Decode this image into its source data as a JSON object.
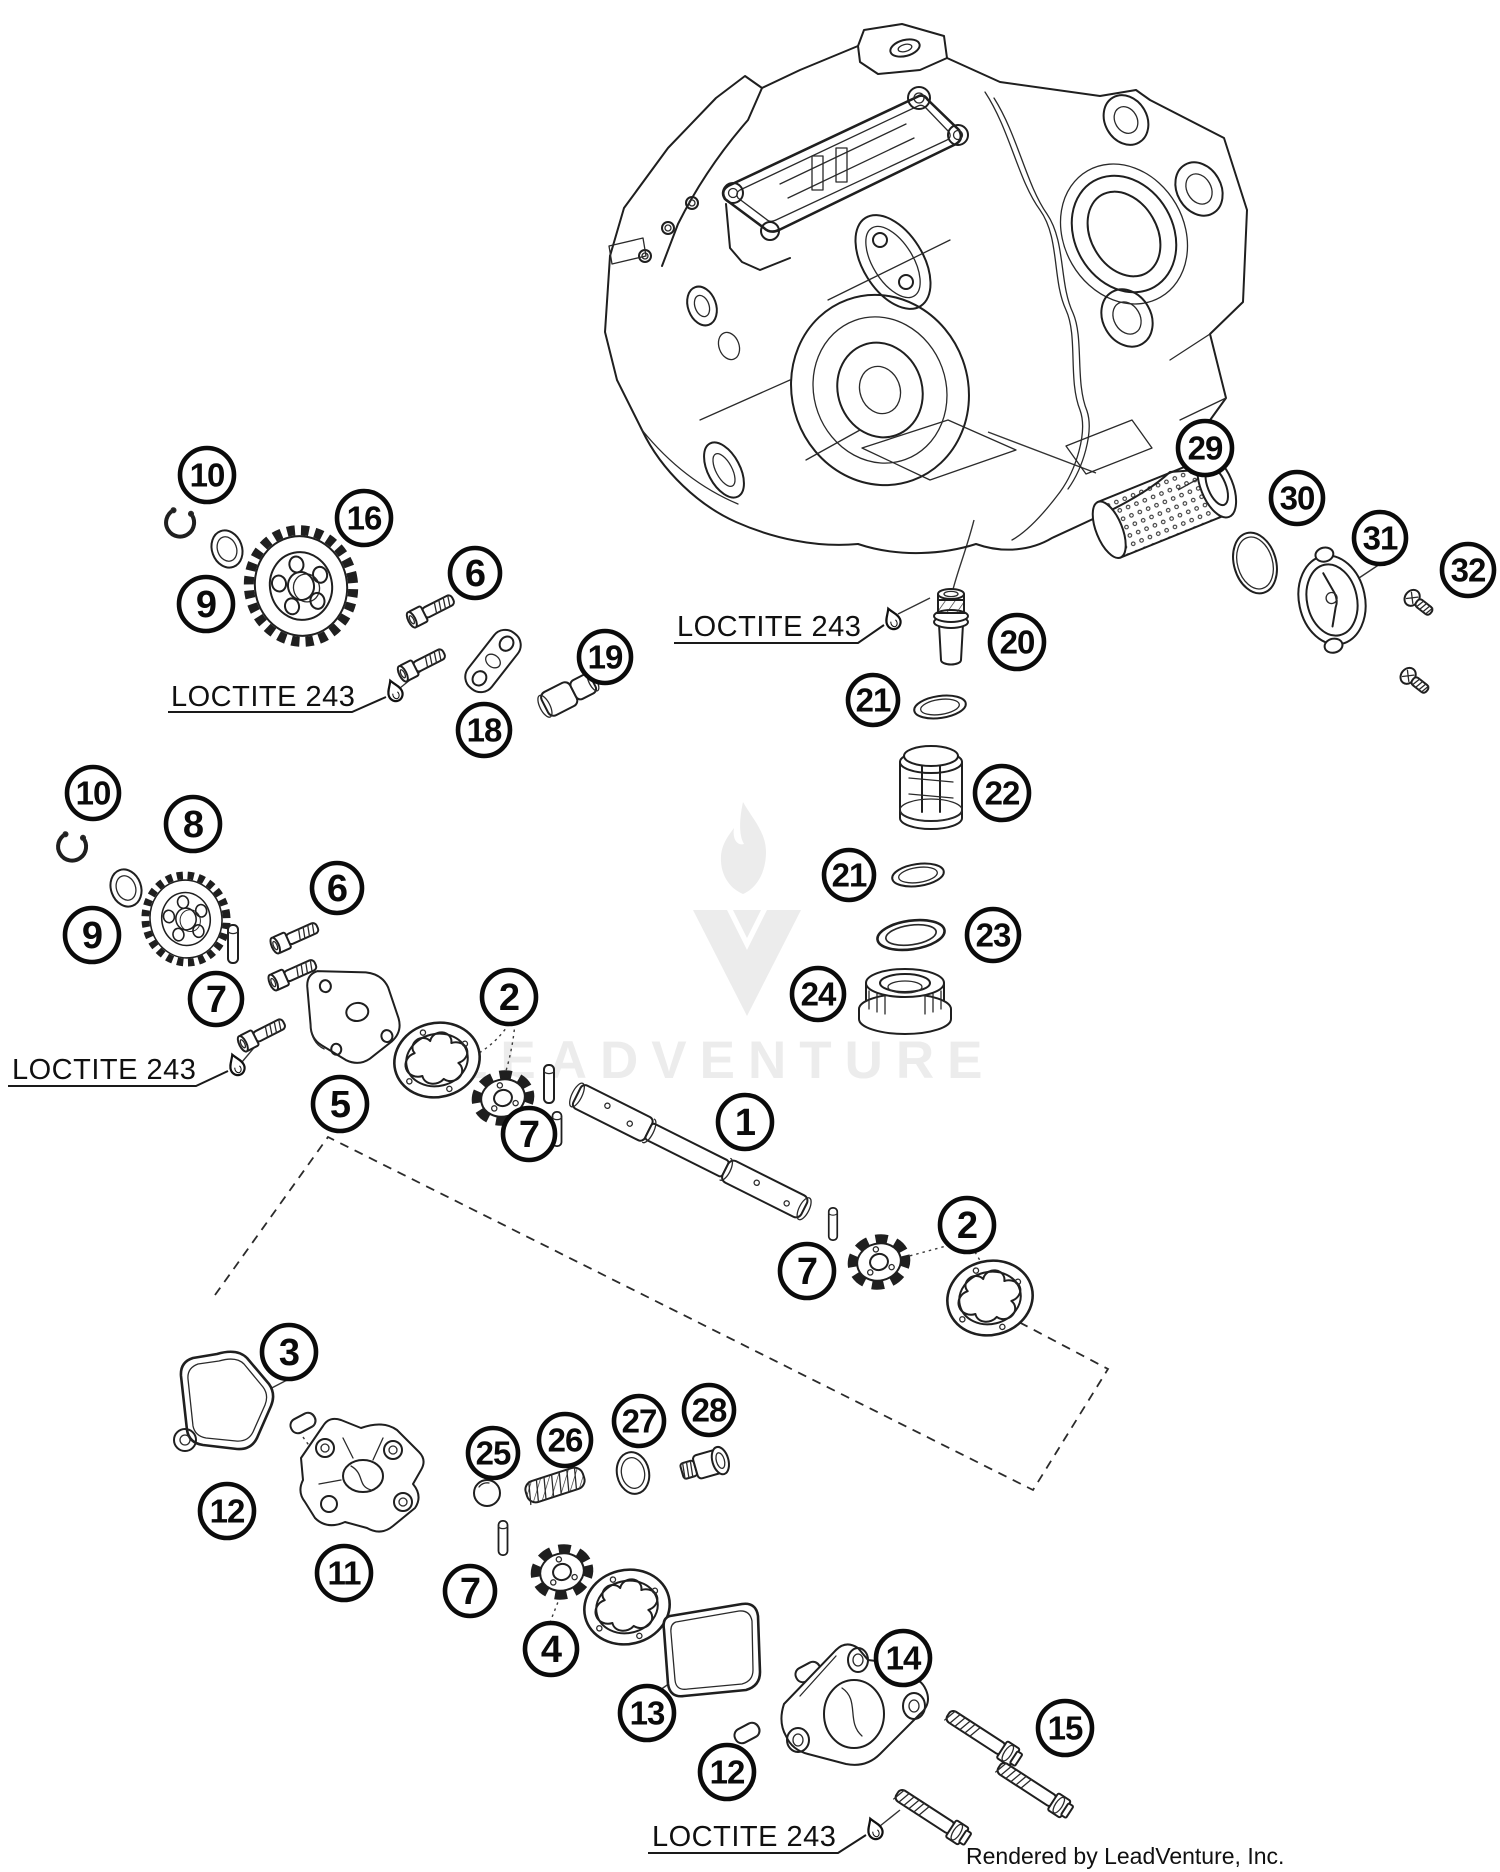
{
  "colors": {
    "line": "#1f1f1f",
    "callout": "#0b0b0b",
    "watermark": "#ececec",
    "background": "#ffffff"
  },
  "watermark": {
    "text": "LEADVENTURE"
  },
  "footer": {
    "credit": "Rendered by LeadVenture, Inc."
  },
  "annotations": {
    "loctite": [
      {
        "text": "LOCTITE 243",
        "tx": 171,
        "ty": 706,
        "ux1": 168,
        "ux2": 352,
        "uy": 712,
        "lx": 386,
        "ly": 697,
        "dx": 394,
        "dy": 690
      },
      {
        "text": "LOCTITE 243",
        "tx": 12,
        "ty": 1079,
        "ux1": 8,
        "ux2": 196,
        "uy": 1086,
        "lx": 228,
        "ly": 1071,
        "dx": 236,
        "dy": 1064
      },
      {
        "text": "LOCTITE 243",
        "tx": 677,
        "ty": 636,
        "ux1": 674,
        "ux2": 858,
        "uy": 643,
        "lx": 884,
        "ly": 625,
        "dx": 892,
        "dy": 618
      },
      {
        "text": "LOCTITE 243",
        "tx": 652,
        "ty": 1846,
        "ux1": 648,
        "ux2": 838,
        "uy": 1853,
        "lx": 866,
        "ly": 1835,
        "dx": 874,
        "dy": 1828
      }
    ]
  },
  "callouts": [
    {
      "label": "10",
      "x": 207,
      "y": 475,
      "r": 27
    },
    {
      "label": "16",
      "x": 364,
      "y": 518,
      "r": 27
    },
    {
      "label": "9",
      "x": 206,
      "y": 604,
      "r": 27
    },
    {
      "label": "6",
      "x": 475,
      "y": 573,
      "r": 25
    },
    {
      "label": "19",
      "x": 605,
      "y": 657,
      "r": 26
    },
    {
      "label": "18",
      "x": 484,
      "y": 730,
      "r": 26
    },
    {
      "label": "29",
      "x": 1205,
      "y": 448,
      "r": 27
    },
    {
      "label": "30",
      "x": 1297,
      "y": 498,
      "r": 26
    },
    {
      "label": "31",
      "x": 1380,
      "y": 538,
      "r": 26
    },
    {
      "label": "32",
      "x": 1468,
      "y": 570,
      "r": 26
    },
    {
      "label": "20",
      "x": 1017,
      "y": 642,
      "r": 27
    },
    {
      "label": "21",
      "x": 873,
      "y": 700,
      "r": 25
    },
    {
      "label": "22",
      "x": 1002,
      "y": 793,
      "r": 27
    },
    {
      "label": "21",
      "x": 849,
      "y": 875,
      "r": 25
    },
    {
      "label": "23",
      "x": 993,
      "y": 935,
      "r": 26
    },
    {
      "label": "24",
      "x": 818,
      "y": 994,
      "r": 26
    },
    {
      "label": "10",
      "x": 93,
      "y": 793,
      "r": 26
    },
    {
      "label": "8",
      "x": 193,
      "y": 824,
      "r": 27
    },
    {
      "label": "9",
      "x": 92,
      "y": 935,
      "r": 27
    },
    {
      "label": "6",
      "x": 337,
      "y": 888,
      "r": 25
    },
    {
      "label": "7",
      "x": 216,
      "y": 999,
      "r": 26
    },
    {
      "label": "5",
      "x": 340,
      "y": 1104,
      "r": 27
    },
    {
      "label": "2",
      "x": 509,
      "y": 997,
      "r": 27
    },
    {
      "label": "7",
      "x": 529,
      "y": 1134,
      "r": 26
    },
    {
      "label": "1",
      "x": 745,
      "y": 1122,
      "r": 27
    },
    {
      "label": "2",
      "x": 967,
      "y": 1225,
      "r": 27
    },
    {
      "label": "7",
      "x": 807,
      "y": 1271,
      "r": 27
    },
    {
      "label": "3",
      "x": 289,
      "y": 1352,
      "r": 27
    },
    {
      "label": "12",
      "x": 227,
      "y": 1511,
      "r": 27
    },
    {
      "label": "11",
      "x": 344,
      "y": 1573,
      "r": 27
    },
    {
      "label": "25",
      "x": 493,
      "y": 1453,
      "r": 25
    },
    {
      "label": "26",
      "x": 565,
      "y": 1440,
      "r": 26
    },
    {
      "label": "27",
      "x": 639,
      "y": 1421,
      "r": 25
    },
    {
      "label": "28",
      "x": 709,
      "y": 1410,
      "r": 25
    },
    {
      "label": "7",
      "x": 470,
      "y": 1591,
      "r": 25
    },
    {
      "label": "4",
      "x": 551,
      "y": 1649,
      "r": 26
    },
    {
      "label": "13",
      "x": 647,
      "y": 1713,
      "r": 27
    },
    {
      "label": "14",
      "x": 903,
      "y": 1658,
      "r": 27
    },
    {
      "label": "12",
      "x": 727,
      "y": 1772,
      "r": 27
    },
    {
      "label": "15",
      "x": 1065,
      "y": 1728,
      "r": 27
    }
  ]
}
